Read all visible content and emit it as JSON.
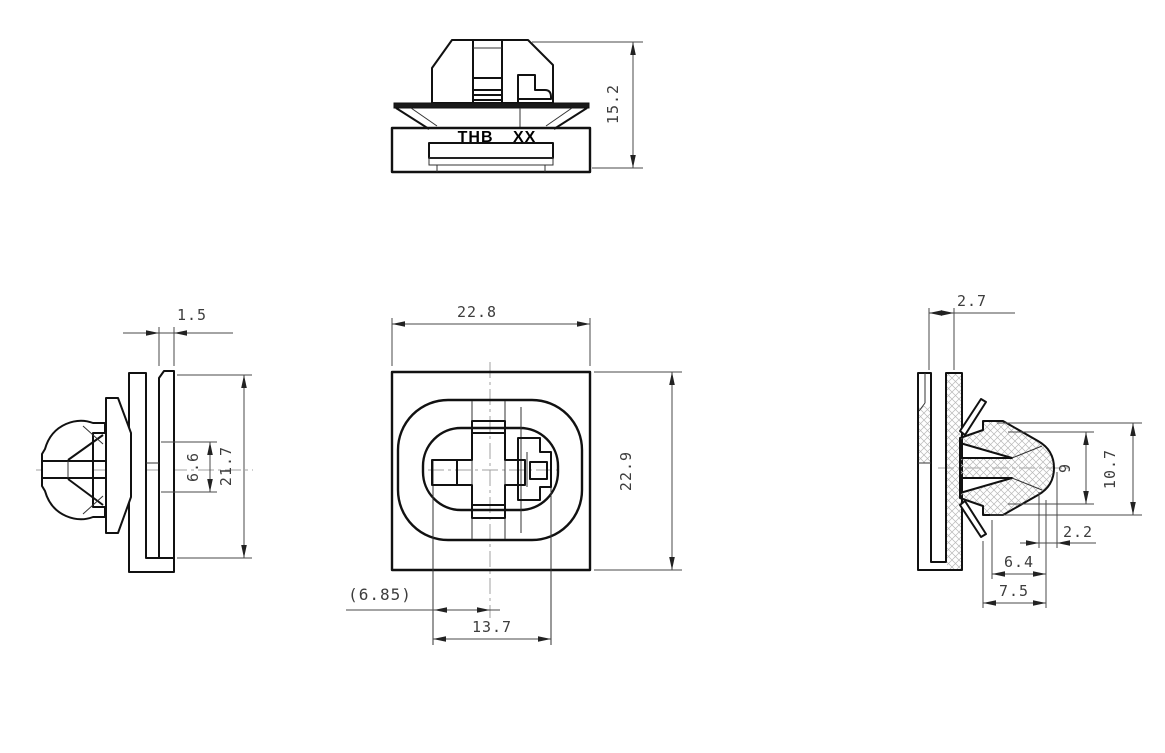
{
  "drawing": {
    "part_marking": "THB XX",
    "views": {
      "front": {
        "dim_height": "15.2"
      },
      "left": {
        "dim_gap": "1.5",
        "dim_inner_height": "6.6",
        "dim_overall_height": "21.7"
      },
      "face": {
        "dim_width": "22.8",
        "dim_height": "22.9",
        "dim_ref_offset": "(6.85)",
        "dim_slot_length": "13.7"
      },
      "section": {
        "dim_panel": "2.7",
        "dim_head_inner": "9",
        "dim_head_overall": "10.7",
        "dim_tip": "2.2",
        "dim_mid": "6.4",
        "dim_overall": "7.5"
      }
    },
    "colors": {
      "line": "#111111",
      "dimension": "#3d3d3d",
      "centerline": "#a0a0a0",
      "hatch": "#b8b8b8",
      "background": "#ffffff"
    }
  }
}
